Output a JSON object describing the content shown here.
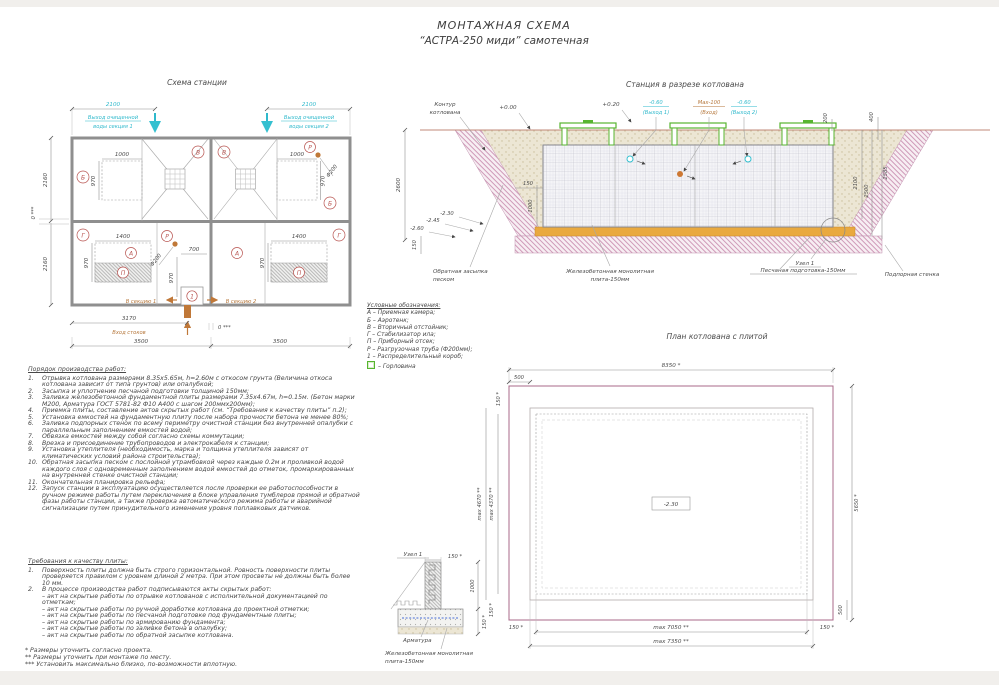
{
  "header": {
    "l1": "МОНТАЖНАЯ СХЕМА",
    "l2": "“АСТРА-250 миди” самотечная"
  },
  "plan": {
    "title": "Схема станции",
    "out1a": "Выход очищенной",
    "out1b": "воды секция 1",
    "out2a": "Выход очищенной",
    "out2b": "воды секция 2",
    "d2100l": "2100",
    "d2100r": "2100",
    "d2160t": "2160",
    "d2160b": "2160",
    "gapL": "0 ***",
    "gapB": "0 ***",
    "d1000l": "1000",
    "d970tl": "970",
    "d1000r": "1000",
    "d970tr": "970",
    "d1400l": "1400",
    "d970bl": "970",
    "d1400r": "1400",
    "d970br": "970",
    "d700": "700",
    "d970m": "970",
    "d3170": "3170",
    "d3500l": "3500",
    "d3500r": "3500",
    "f200a": "Ф200",
    "f200b": "Ф200",
    "insec1": "В секцию 1",
    "insec2": "В секцию 2",
    "inlet": "Вход стоков",
    "rB1": "Б",
    "rB2": "Б",
    "rV1": "В",
    "rV2": "В",
    "rG1": "Г",
    "rG2": "Г",
    "rA1": "А",
    "rA2": "А",
    "rP1": "П",
    "rP2": "П",
    "rR1": "Р",
    "rR2": "Р",
    "rK1": "1"
  },
  "sect": {
    "title": "Станция в разрезе котлована",
    "contour1": "Контур",
    "contour2": "котлована",
    "e000": "+0.00",
    "e020": "+0.20",
    "out1v": "-0.60",
    "out1n": "(Выход 1)",
    "inv": "Max-100",
    "inn": "(Вход)",
    "out2v": "-0.60",
    "out2n": "(Выход 2)",
    "d200": "200",
    "d400": "400",
    "d2100": "2100",
    "d2500": "2500",
    "d2585": "2585",
    "d2600": "2600",
    "m245": "-2.45",
    "m230": "-2.30",
    "m260": "-2.60",
    "d150sp": "150",
    "d150pl": "150",
    "d1000": "1000",
    "backfill1": "Обратная засыпка",
    "backfill2": "песком",
    "slab1": "Железобетонная монолитная",
    "slab2": "плита-150мм",
    "sand": "Песчаная подготовка-150мм",
    "wall": "Подпорная стенка",
    "node": "Узел 1"
  },
  "legend": {
    "title": "Условные обозначения:",
    "i0": "А – Приемная камера;",
    "i1": "Б – Аэротенк;",
    "i2": "В – Вторичный отстойник;",
    "i3": "Г – Стабилизатор ила;",
    "i4": "П – Приборный отсек;",
    "i5": "Р – Разгрузочная труба (Ф200мм);",
    "i6": "1 – Распределительный короб;",
    "i7": "– Горловина"
  },
  "pit": {
    "title": "План котлована с плитой",
    "d8350": "8350 *",
    "d500t": "500",
    "d150tl": "150 *",
    "d4670": "max 4670 **",
    "d4370": "max 4370 **",
    "d5650": "5650 *",
    "m230": "-2.30",
    "d7050": "max 7050 **",
    "d7350": "max 7350 **",
    "d150bl": "150 *",
    "d150br": "150 *",
    "d150l": "150 *",
    "d500b": "500"
  },
  "node": {
    "title": "Узел 1",
    "d150t": "150 *",
    "d1000": "1000",
    "d150b": "150 *",
    "rebar": "Арматура",
    "slab1": "Железобетонная монолитная",
    "slab2": "плита-150мм"
  },
  "wo": {
    "title": "Порядок производства работ:",
    "items": [
      {
        "n": "1.",
        "t": "Отрывка котлована размерами 8.35х5.65м, h=2.60м с откосом грунта (Величина откоса котлована зависит от типа грунтов) или опалубкой;"
      },
      {
        "n": "2.",
        "t": "Засыпка и уплотнение песчаной подготовки толщиной 150мм;"
      },
      {
        "n": "3.",
        "t": "Заливка железобетонной фундаментной плиты размерами 7.35х4.67м, h=0.15м. (Бетон марки М200, Арматура ГОСТ 5781-82 Ф10 А400 с шагом 200ммх200мм);"
      },
      {
        "n": "4.",
        "t": "Приемка плиты, составление актов скрытых работ (см. “Требования к качеству плиты” п.2);"
      },
      {
        "n": "5.",
        "t": "Установка емкостей на фундаментную плиту после набора прочности бетона не менее 80%;"
      },
      {
        "n": "6.",
        "t": "Заливка подпорных стенок по всему периметру очистной станции без внутренней опалубки с параллельным заполнением емкостей водой;"
      },
      {
        "n": "7.",
        "t": "Обвязка емкостей между собой согласно схемы коммутации;"
      },
      {
        "n": "8.",
        "t": "Врезка и присоединение трубопроводов и электрокабеля к станции;"
      },
      {
        "n": "9.",
        "t": "Установка утеплителя (необходимость, марка и толщина утеплителя зависят от климатических условий района строительства);"
      },
      {
        "n": "10.",
        "t": "Обратная засыпка песком с послойной утрамбовкой через каждые 0.2м и проливкой водой каждого слоя с одновременным заполнением водой емкостей до отметок, промаркированных на внутренней стенке очистной станции;"
      },
      {
        "n": "11.",
        "t": "Окончательная планировка рельефа;"
      },
      {
        "n": "12.",
        "t": "Запуск станции в эксплуатацию осуществляется после проверки ее работоспособности в ручном режиме работы путем переключения в блоке управления тумблеров прямой и обратной фазы работы станции, а также проверка автоматического режима работы и аварийной сигнализации путем принудительного изменения уровня поплавковых датчиков."
      }
    ]
  },
  "qa": {
    "title": "Требования к качеству плиты:",
    "items": [
      {
        "n": "1.",
        "t": "Поверхность плиты должна быть строго горизонтальной. Ровность поверхности плиты проверяется правилом с уровнем длиной 2 метра. При этом просветы не должны быть более 10 мм."
      },
      {
        "n": "2.",
        "t": "В процессе производства работ подписываются акты скрытых работ:"
      }
    ],
    "b": [
      "– акт на скрытые работы по отрывке котлованов с исполнительной документацией по отметкам;",
      "– акт на скрытые работы по ручной доработке котлована до проектной отметки;",
      "– акт на скрытые работы по песчаной подготовке под фундаментные плиты;",
      "– акт на скрытые работы по армированию фундамента;",
      "– акт на скрытые работы по заливке бетона в опалубку;",
      "– акт на скрытые работы по обратной засыпке котлована."
    ]
  },
  "notes": [
    "*  Размеры уточнить согласно проекта.",
    "**  Размеры уточнить при монтаже по месту.",
    "***  Установить максимально близко, по-возможности вплотную."
  ]
}
